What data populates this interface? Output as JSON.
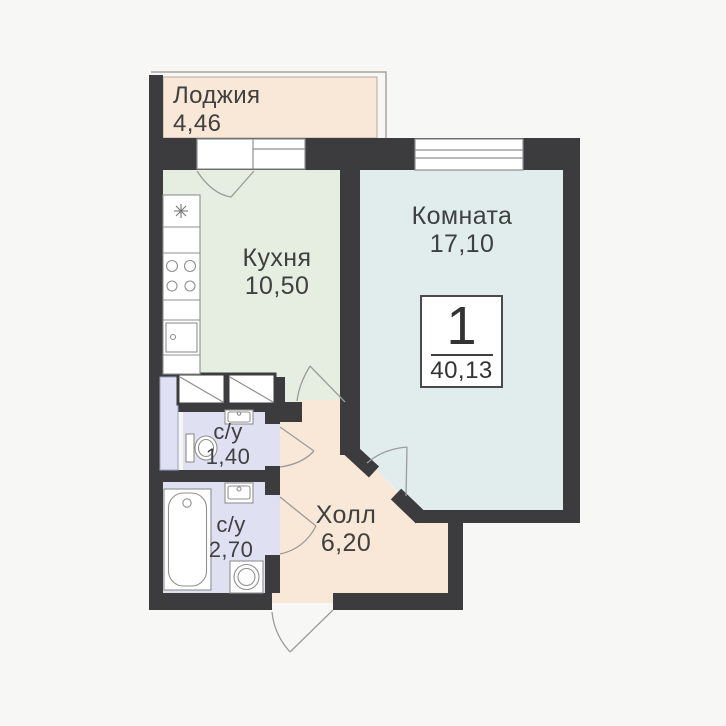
{
  "plan": {
    "badge": {
      "rooms_count": "1",
      "total_area": "40,13"
    },
    "rooms": [
      {
        "key": "loggia",
        "name": "Лоджия",
        "area": "4,46"
      },
      {
        "key": "kitchen",
        "name": "Кухня",
        "area": "10,50"
      },
      {
        "key": "living-room",
        "name": "Комната",
        "area": "17,10"
      },
      {
        "key": "bathroom-1",
        "name": "с/у",
        "area": "1,40"
      },
      {
        "key": "bathroom-2",
        "name": "с/у",
        "area": "2,70"
      },
      {
        "key": "hall",
        "name": "Холл",
        "area": "6,20"
      }
    ],
    "colors": {
      "background": "#f7f7f5",
      "walls": "#3c3c3e",
      "loggia": "#f9e7d7",
      "hall": "#f9e7d7",
      "kitchen": "#e6ede1",
      "living_room": "#e0edec",
      "bathroom": "#dfe1f3",
      "fixture_line": "#8f8f8f",
      "door_arc": "#9b9b9b"
    }
  }
}
